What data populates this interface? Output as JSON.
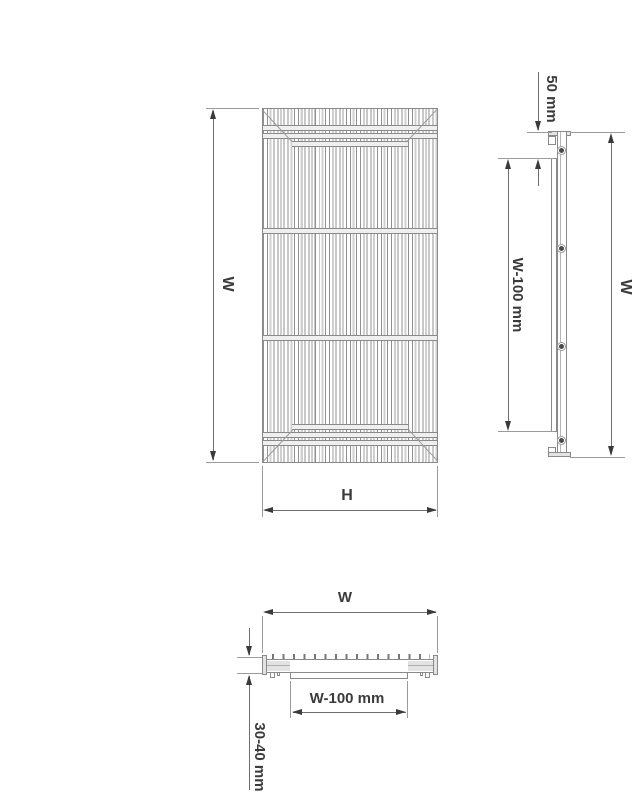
{
  "drawing": {
    "views": {
      "front": {
        "width_label": "W",
        "height_label": "H"
      },
      "side": {
        "offset_label": "50 mm",
        "rail_label": "W-100 mm",
        "height_label": "W"
      },
      "bottom": {
        "width_label": "W",
        "channel_label": "W-100 mm",
        "thickness_label": "30-40 mm"
      }
    }
  },
  "colors": {
    "line": "#8a8a8a",
    "dim": "#6e6e6e",
    "ext": "#9b9b9b",
    "arrow": "#3a3a3a",
    "text": "#3b3b3b",
    "fill": "#e3e3e3",
    "background": "#ffffff"
  }
}
